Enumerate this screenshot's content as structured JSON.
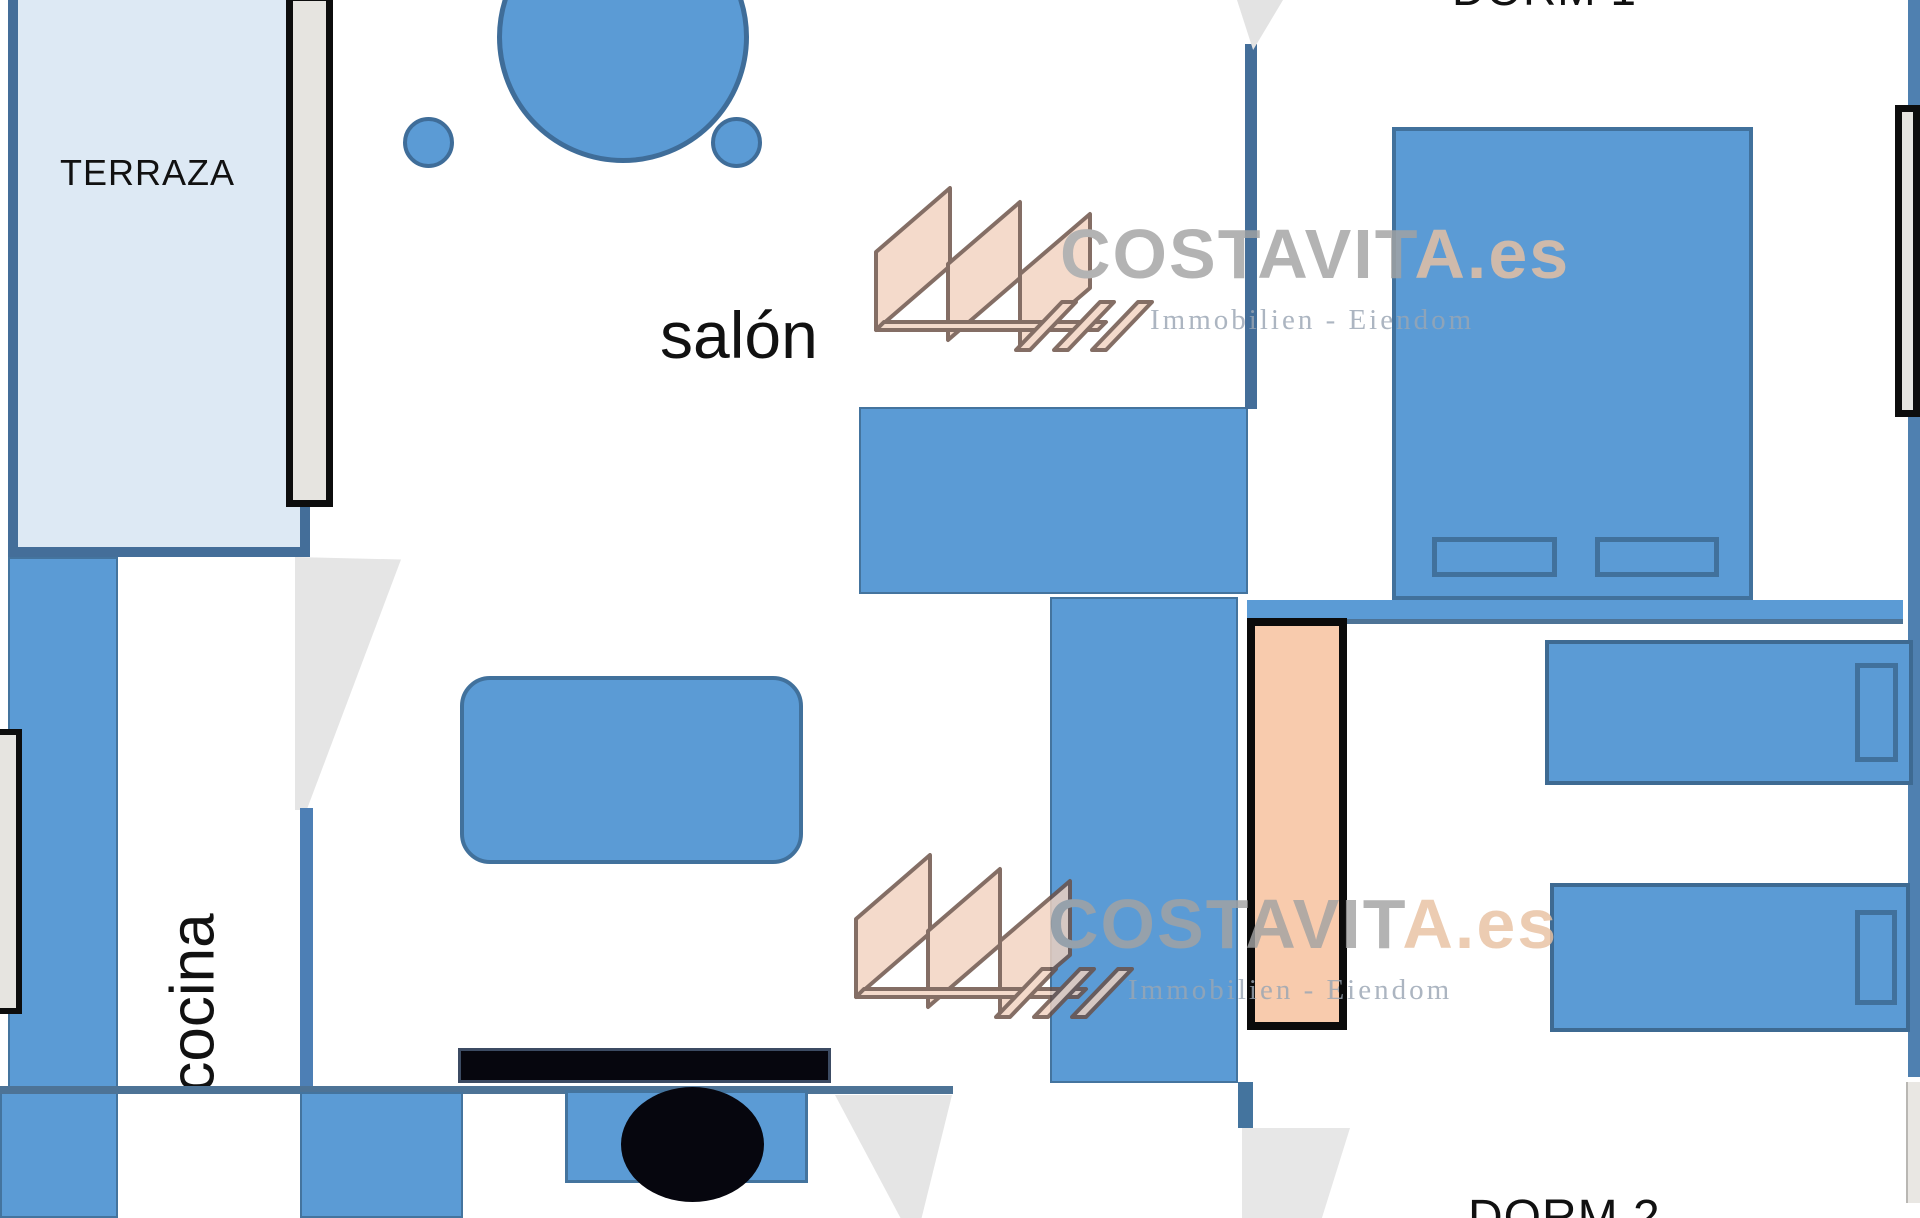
{
  "page": {
    "width": 1920,
    "height": 1218,
    "background": "#ffffff",
    "type": "apartment floor plan"
  },
  "rooms": {
    "terraza": {
      "label": "TERRAZA"
    },
    "salon": {
      "label": "salón"
    },
    "cocina": {
      "label": "cocina"
    },
    "dorm1": {
      "label": "DORM 1"
    },
    "dorm2": {
      "label": "DORM 2"
    }
  },
  "watermarks": [
    {
      "brand_main": "COSTAVIT",
      "brand_accent": "A.es",
      "tagline": "Immobilien - Eiendom"
    },
    {
      "brand_main": "COSTAVIT",
      "brand_accent": "A.es",
      "tagline": "Immobilien - Eiendom"
    }
  ],
  "icons": {
    "logo": "costavita-sails-logo"
  },
  "colors": {
    "furniture_blue": "#5b9bd5",
    "furniture_border": "#41719c",
    "terrace_fill": "#dde9f4",
    "terrace_border": "#446e99",
    "door_peach": "#f8cbad",
    "door_peach_border": "#0b0b0b",
    "window_fill": "#e6e4e0",
    "window_border": "#0d0d0d",
    "door_swing_gray": "#e5e5e5",
    "wall_dark": "#4d7396",
    "fixture_black": "#06060e",
    "brand_gray": "#a3a3a3",
    "brand_peach": "#e9c2a2",
    "tagline_gray": "#9aa6b4"
  }
}
